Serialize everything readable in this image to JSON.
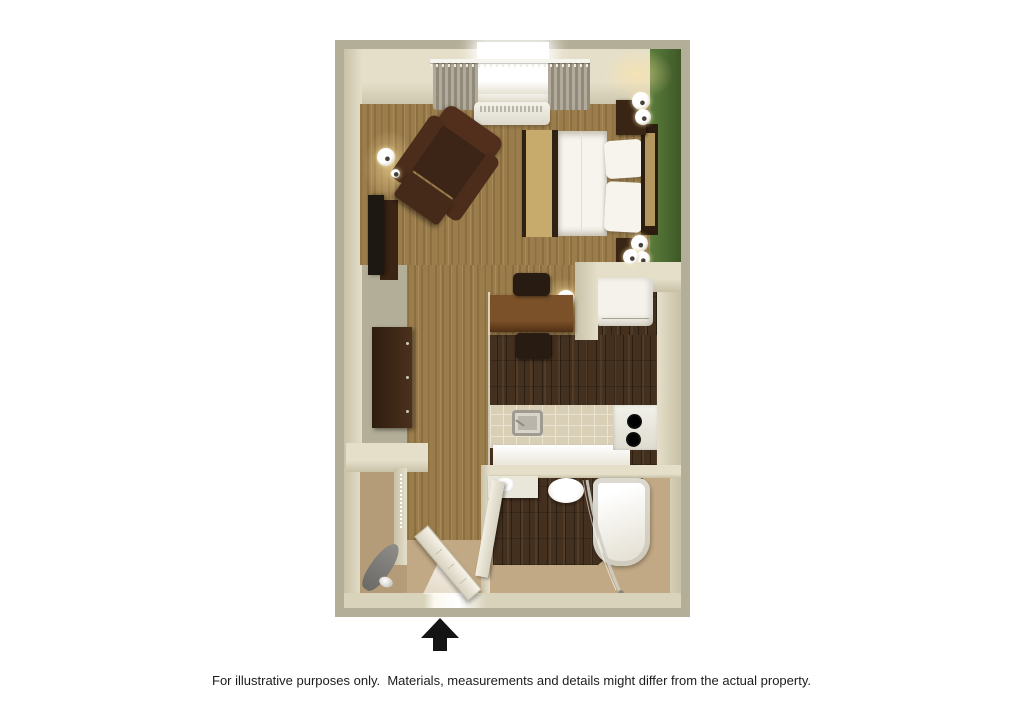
{
  "caption": {
    "text": "For illustrative purposes only.  Materials, measurements and details might differ from the actual property."
  },
  "entry": {
    "arrow_direction": "up"
  },
  "legend": {
    "type": "floor-plan",
    "rooms": [
      "sleeping-living-area",
      "kitchen",
      "bathroom",
      "closet",
      "entry"
    ],
    "elements": [
      "window-with-curtains",
      "air-conditioner",
      "armchair",
      "tv-console",
      "bed",
      "nightstands",
      "wall-lamps",
      "dresser",
      "closet-shelf",
      "hanging-rod",
      "ironing-board",
      "iron",
      "desk",
      "chairs",
      "refrigerator",
      "counter-with-sink",
      "cooktop",
      "vanity-sink",
      "toilet",
      "bathtub",
      "shower-door",
      "bathroom-door",
      "entry-door"
    ]
  },
  "palette": {
    "wall_outer": "#b3ae97",
    "wall_face": "#e5dfca",
    "wall_face_dark": "#c8c1a7",
    "wall_front": "#d9d3bb",
    "green_light": "#5a7c3c",
    "green_dark": "#3e5827",
    "carpet": "#9b7d4c",
    "wood_dark": "#44301e",
    "bath_beige": "#c2a985",
    "closet_beige": "#b59c78",
    "tile": "#d8cfb6",
    "tile_line": "#e9e3d1",
    "bed_white": "#f6f4ed",
    "runner": "#c6ab6d",
    "stripe_dark": "#2e2214",
    "headboard_tan": "#b4975e",
    "dark_wood_furn": "#3a2514",
    "chair_dark": "#281b12",
    "leather": "#4c2d1b",
    "curtain_a": "#b2aa9a",
    "curtain_b": "#918979",
    "tv": "#1e1813",
    "metal": "#b9b5aa",
    "burner": "#161616",
    "glass": "#cfcdc4",
    "lamp_glow": "rgba(255,228,160,0.55)",
    "arrow": "#141414",
    "caption": "#1c1c1c"
  }
}
